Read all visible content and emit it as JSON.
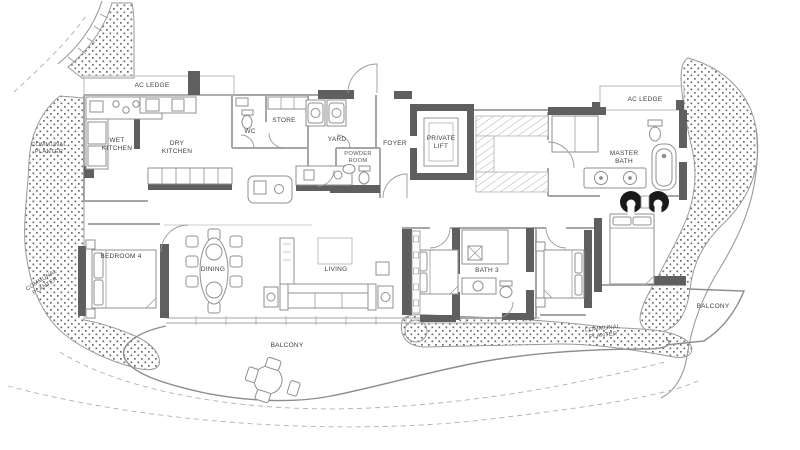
{
  "rooms": {
    "ac_ledge_left": "AC LEDGE",
    "wet_kitchen": "WET\nKITCHEN",
    "dry_kitchen": "DRY\nKITCHEN",
    "wc": "WC",
    "store": "STORE",
    "yard": "YARD",
    "powder_room": "POWDER\nROOM",
    "foyer": "FOYER",
    "private_lift": "PRIVATE\nLIFT",
    "ac_ledge_right": "AC LEDGE",
    "master_bath": "MASTER\nBATH",
    "bedroom_4": "BEDROOM 4",
    "dining": "DINING",
    "living": "LIVING",
    "bath_3": "BATH 3"
  },
  "outdoor": {
    "balcony_main": "BALCONY",
    "balcony_right": "BALCONY",
    "communal_planter_top_left": "COMMUNAL\nPLANTER",
    "communal_planter_bottom_left": "COMMUNAL\nPLANTER",
    "communal_planter_right": "COMMUNAL\nPLANTER"
  },
  "colors": {
    "background": "#ffffff",
    "wall_dark": "#5f5f5f",
    "wall_light": "#a6a6a6",
    "furniture_line": "#8f8f8f",
    "planter_dot": "#6a6a6a",
    "label_text": "#3f3f3f",
    "accent_chair": "#1a1a1a"
  }
}
